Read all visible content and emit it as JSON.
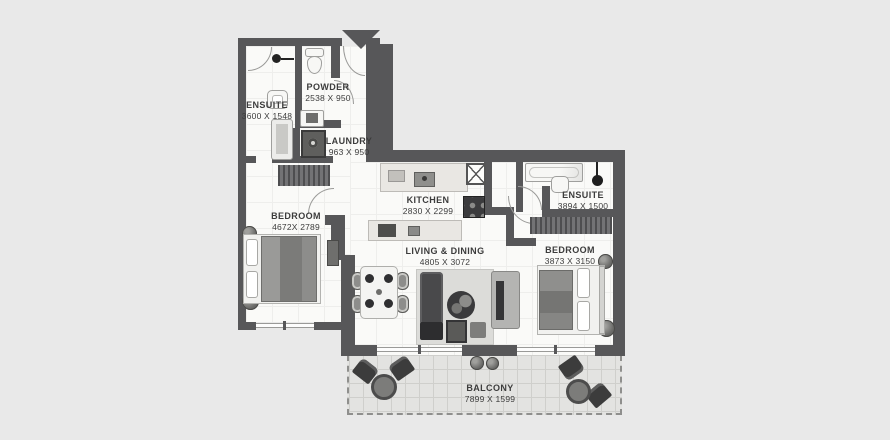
{
  "plan": {
    "type": "apartment-floor-plan",
    "style": "grayscale architectural top view"
  },
  "colors": {
    "background": "#e9e9e9",
    "wall": "#575759",
    "floor": "#fafaf8",
    "balcony_tile": "#e3e3e1",
    "label_text": "#3c3c3c"
  },
  "rooms": [
    {
      "id": "ensuite-1",
      "name": "ENSUITE",
      "dims": "3600 X 1548"
    },
    {
      "id": "powder",
      "name": "POWDER",
      "dims": "2538 X 950"
    },
    {
      "id": "laundry",
      "name": "LAUNDRY",
      "dims": "963 X 950"
    },
    {
      "id": "bedroom-1",
      "name": "BEDROOM",
      "dims": "4672X 2789"
    },
    {
      "id": "kitchen",
      "name": "KITCHEN",
      "dims": "2830 X 2299"
    },
    {
      "id": "living-dining",
      "name": "LIVING & DINING",
      "dims": "4805 X 3072"
    },
    {
      "id": "ensuite-2",
      "name": "ENSUITE",
      "dims": "3894 X 1500"
    },
    {
      "id": "bedroom-2",
      "name": "BEDROOM",
      "dims": "3873 X 3150"
    },
    {
      "id": "balcony",
      "name": "BALCONY",
      "dims": "7899 X 1599"
    }
  ],
  "icons": {
    "entry": "entry-arrow",
    "shower_left": "shower-head-icon",
    "shower_right": "shower-head-icon"
  }
}
